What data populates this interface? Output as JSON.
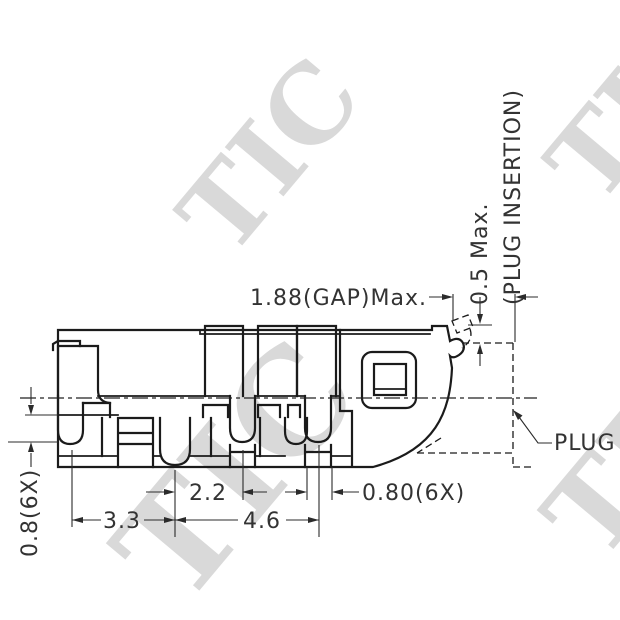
{
  "drawing": {
    "title": "connector-cross-section",
    "watermark": "TIC",
    "labels": {
      "gap_max": "1.88(GAP)Max.",
      "half_max": "0.5 Max.",
      "plug_insertion": "(PLUG INSERTION)",
      "plug": "PLUG",
      "dim_2_2": "2.2",
      "dim_3_3": "3.3",
      "dim_4_6": "4.6",
      "dim_0_80_6x": "0.80(6X)",
      "dim_0_8_6x": "0.8(6X)"
    },
    "colors": {
      "line": "#1b1b1b",
      "dimension": "#2b2b2b",
      "text": "#333333",
      "watermark": "#d9d9d9",
      "background": "#ffffff"
    }
  }
}
